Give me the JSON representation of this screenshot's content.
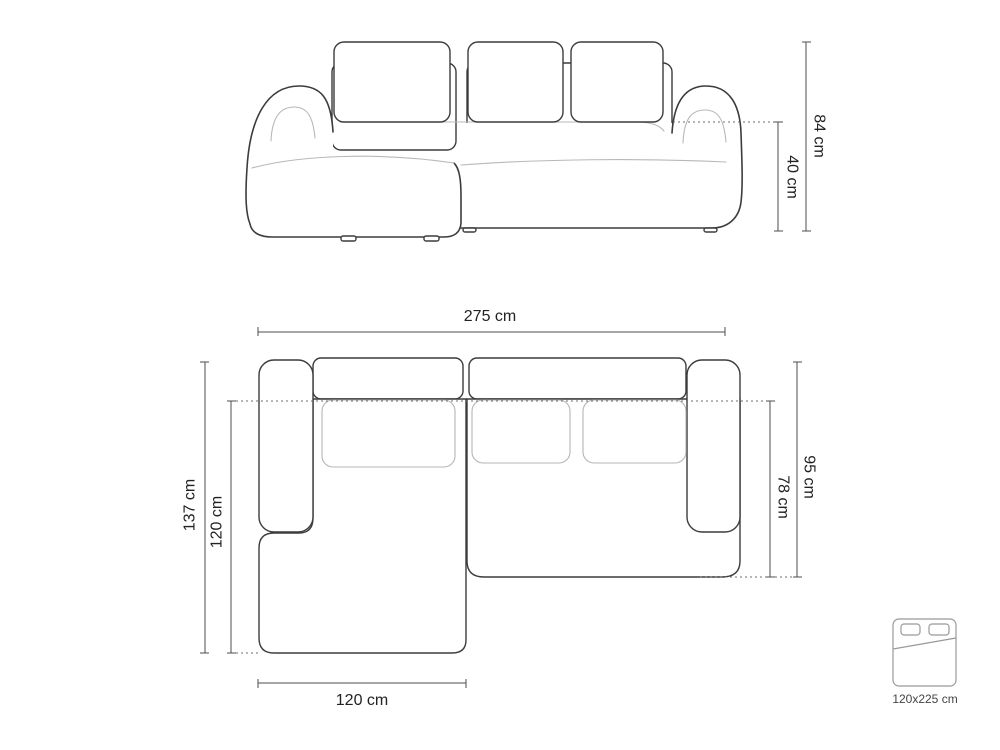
{
  "diagram": {
    "front_view": {
      "overall_height": "84 cm",
      "seat_height": "40 cm"
    },
    "top_view": {
      "overall_width": "275 cm",
      "overall_depth": "137 cm",
      "chaise_depth": "120 cm",
      "side_depth": "95 cm",
      "inner_depth": "78 cm",
      "chaise_width": "120 cm"
    },
    "sleeping_area": {
      "size": "120x225 cm"
    }
  },
  "colors": {
    "outline_dark": "#3c3c3c",
    "outline_light": "#b8b8b8",
    "dimension_lines": "#4d4d4d",
    "label_text": "#222222",
    "background": "#ffffff"
  }
}
